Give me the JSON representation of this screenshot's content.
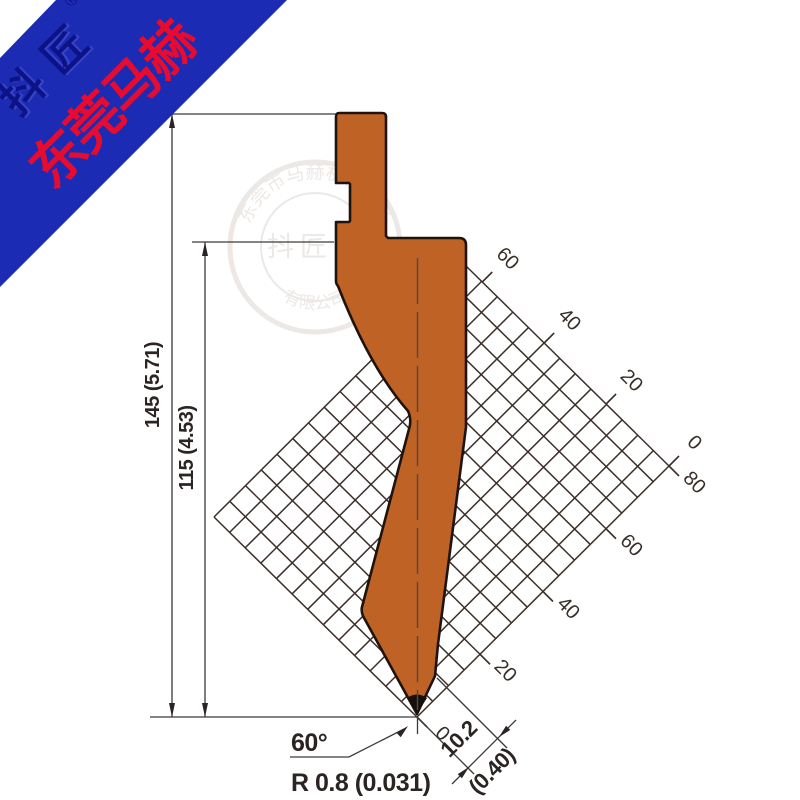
{
  "banner": {
    "brand_main": "东莞马赫",
    "brand_sub": "抖匠",
    "registered": "®"
  },
  "watermark": {
    "ring_top": "东莞市马赫机械设备",
    "ring_bottom": "有限公司",
    "center": "抖匠",
    "center_registered": "®"
  },
  "drawing": {
    "dim_total_height": "145 (5.71)",
    "dim_working_height": "115 (4.53)",
    "tip_angle": "60°",
    "tip_radius": "R 0.8 (0.031)",
    "tip_width_mm": "10.2",
    "tip_width_in": "(0.40)",
    "upper_scale": [
      "60",
      "40",
      "20",
      "0"
    ],
    "lower_scale": [
      "0",
      "20",
      "40",
      "60",
      "80"
    ]
  },
  "colors": {
    "punch": "#bf6226",
    "punch_outline": "#1f140d",
    "tip_cap": "#17100a",
    "banner_bg": "#1c2bb4",
    "banner_text": "#e60b2f",
    "banner_sub_text": "#0b1386"
  }
}
